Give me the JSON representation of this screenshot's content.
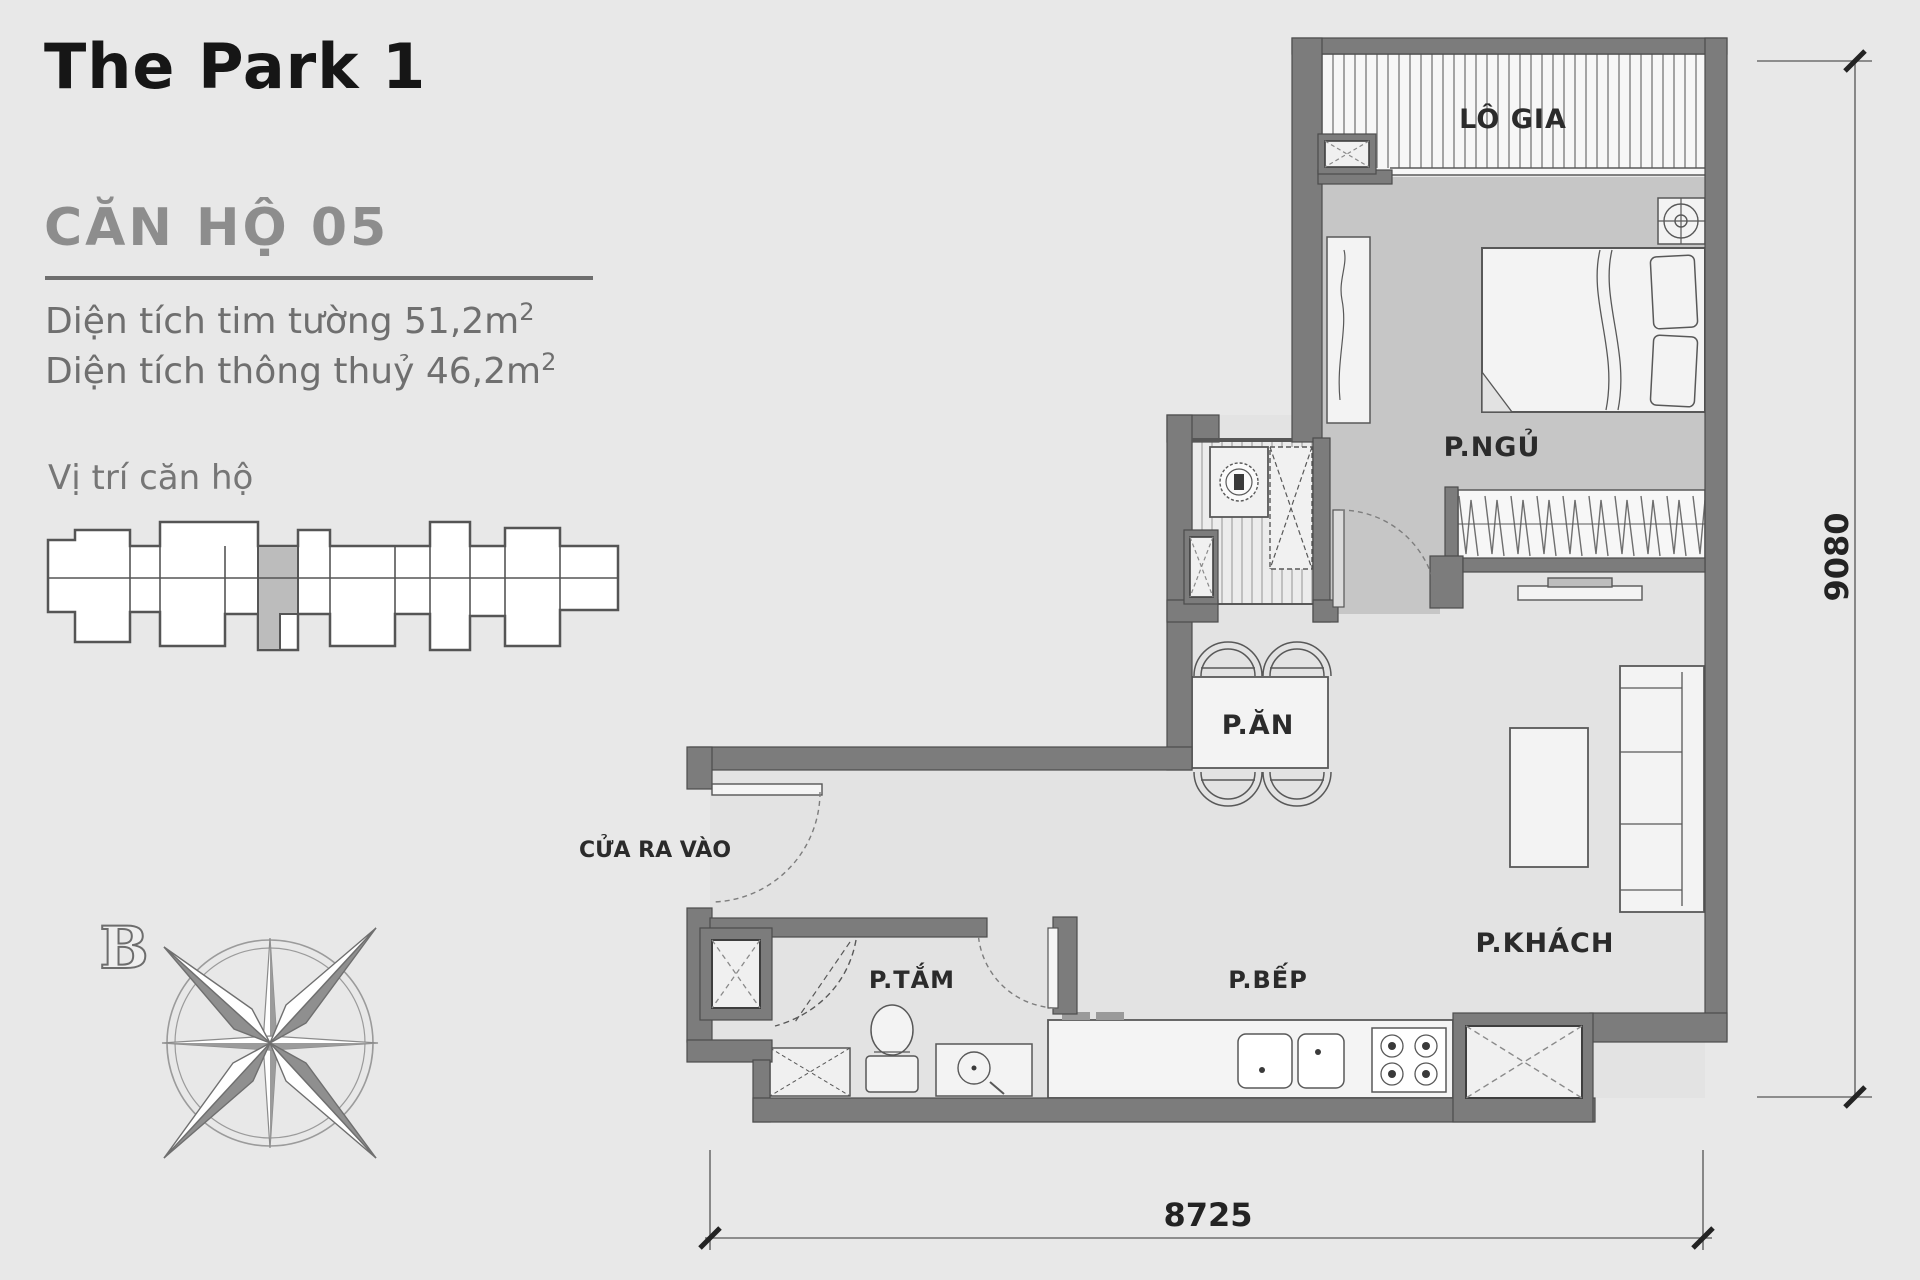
{
  "header": {
    "project_title": "The Park 1",
    "unit_title": "CĂN HỘ 05"
  },
  "areas": {
    "wall_area_label": "Diện tích tim tường",
    "wall_area_value": "51,2m",
    "net_area_label": "Diện tích thông thuỷ",
    "net_area_value": "46,2m",
    "sup": "2"
  },
  "location": {
    "label": "Vị trí căn hộ"
  },
  "compass": {
    "north_label": "B"
  },
  "plan": {
    "rooms": {
      "loggia": "LÔ GIA",
      "bedroom": "P.NGỦ",
      "dining": "P.ĂN",
      "living": "P.KHÁCH",
      "bathroom": "P.TẮM",
      "kitchen": "P.BẾP"
    },
    "entrance_label": "CỬA RA VÀO",
    "dim_bottom": "8725",
    "dim_right": "9080"
  },
  "colors": {
    "background": "#e8e8e8",
    "wall": "#7c7c7c",
    "wall_outline": "#4c4c4c",
    "bedroom_floor": "#c6c6c6",
    "floor": "#e3e3e3",
    "furniture": "#f3f3f3",
    "highlight_unit": "#bcbcbc",
    "dim_line": "#6f6f6f",
    "text_dark": "#2b2b2b",
    "text_gray": "#8d8d8d"
  }
}
